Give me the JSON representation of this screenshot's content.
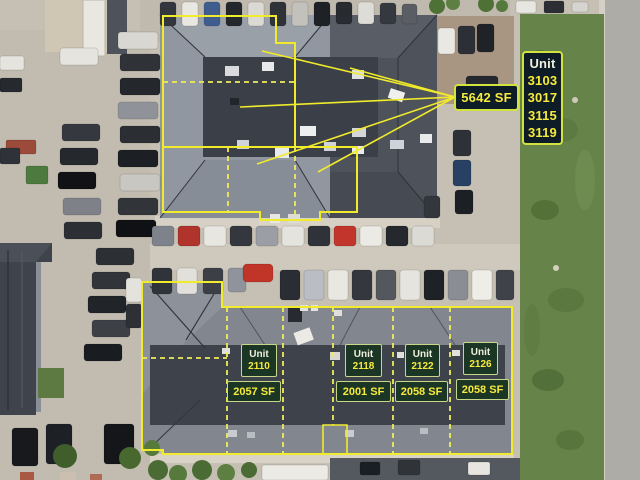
{
  "annotation_colors": {
    "outline_yellow": "#f0eb2b",
    "sign_background": "#0e1c27",
    "sign_border": "#d2e23e",
    "sign_text_yellow": "#f6ea3c",
    "unit_box_background": "#1c3626",
    "unit_box_border": "#c9d78b"
  },
  "north_building": {
    "total_area_label": "5642 SF",
    "unit_sign": {
      "title": "Unit",
      "unit_numbers": [
        "3103",
        "3017",
        "3115",
        "3119"
      ]
    }
  },
  "south_building": {
    "units": [
      {
        "title": "Unit",
        "number": "2110",
        "area": "2057 SF"
      },
      {
        "title": "Unit",
        "number": "2118",
        "area": "2001 SF"
      },
      {
        "title": "Unit",
        "number": "2122",
        "area": "2058 SF"
      },
      {
        "title": "Unit",
        "number": "2126",
        "area": "2058 SF"
      }
    ]
  }
}
